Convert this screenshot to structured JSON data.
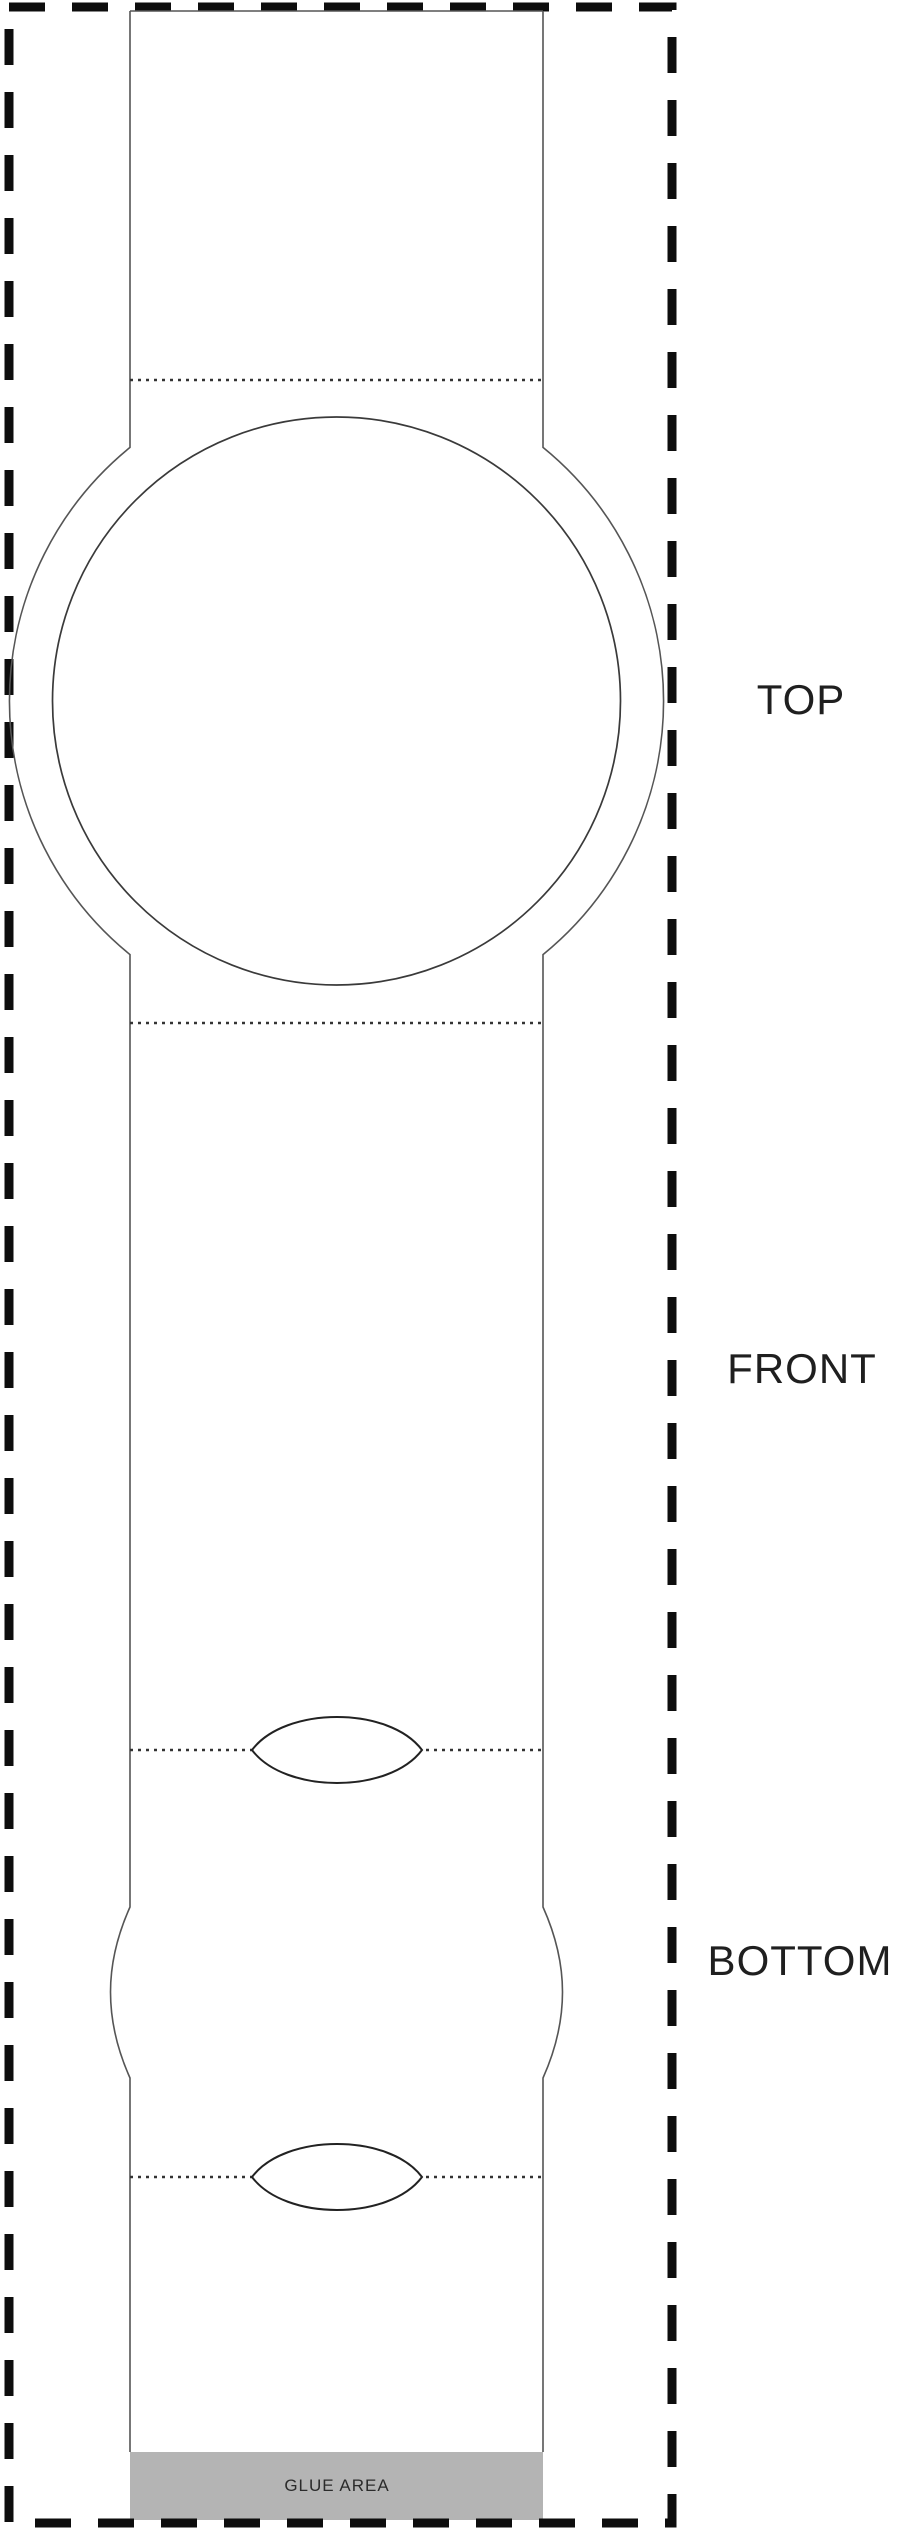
{
  "diagram": {
    "labels": {
      "top": "TOP",
      "front": "FRONT",
      "bottom": "BOTTOM"
    },
    "glue_area": {
      "label": "GLUE AREA",
      "fill_color": "#b4b4b4"
    },
    "line_colors": {
      "cut_dashed_border": "#0d0d0d",
      "template_outline": "#555555",
      "fold_dotted_line": "#333333",
      "circle_outline": "#3a3a3a",
      "lens_outline": "#222222"
    }
  }
}
